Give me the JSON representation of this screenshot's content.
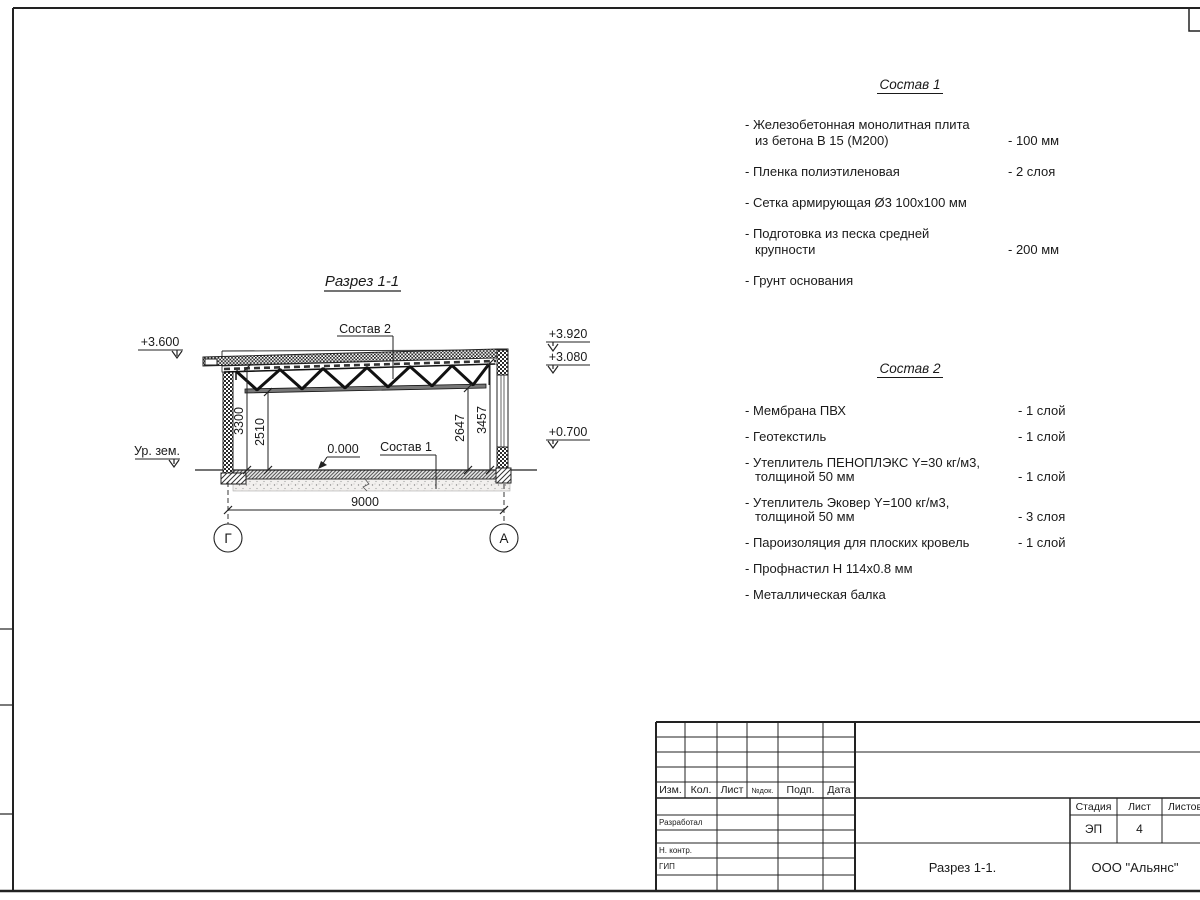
{
  "drawing": {
    "title": "Разрез 1-1",
    "labels": {
      "sostav2_ref": "Состав 2",
      "sostav1_ref": "Состав 1",
      "zero_level": "0.000",
      "ground_level": "Ур. зем."
    },
    "elevations": {
      "left_roof": "+3.600",
      "right_parapet": "+3.920",
      "right_window_top": "+3.080",
      "right_sill": "+0.700"
    },
    "dimensions": {
      "d3300": "3300",
      "d2510": "2510",
      "d2647": "2647",
      "d3457": "3457",
      "d9000": "9000"
    },
    "axes": {
      "left": "Г",
      "right": "А"
    }
  },
  "lists": [
    {
      "title": "Состав 1",
      "items": [
        {
          "lines": [
            "- Железобетонная  монолитная плита",
            "из бетона В 15 (М200)"
          ],
          "value": "- 100 мм"
        },
        {
          "lines": [
            "- Пленка полиэтиленовая"
          ],
          "value": "-  2 слоя"
        },
        {
          "lines": [
            "- Сетка армирующая Ø3 100х100 мм"
          ],
          "value": ""
        },
        {
          "lines": [
            "- Подготовка из песка средней",
            "крупности"
          ],
          "value": "- 200 мм"
        },
        {
          "lines": [
            "- Грунт основания"
          ],
          "value": ""
        }
      ]
    },
    {
      "title": "Состав 2",
      "items": [
        {
          "lines": [
            "- Мембрана ПВХ"
          ],
          "value": "- 1 слой"
        },
        {
          "lines": [
            "- Геотекстиль"
          ],
          "value": "- 1 слой"
        },
        {
          "lines": [
            "- Утеплитель ПЕНОПЛЭКС Y=30 кг/м3,",
            "толщиной 50 мм"
          ],
          "value": "- 1 слой"
        },
        {
          "lines": [
            "- Утеплитель Эковер Y=100 кг/м3,",
            "толщиной 50 мм"
          ],
          "value": "- 3 слоя"
        },
        {
          "lines": [
            "- Пароизоляция для плоских кровель"
          ],
          "value": "- 1 слой"
        },
        {
          "lines": [
            "- Профнастил Н 114х0.8 мм"
          ],
          "value": ""
        },
        {
          "lines": [
            "- Металлическая балка"
          ],
          "value": ""
        }
      ]
    }
  ],
  "title_block": {
    "rev_headers": [
      "Изм.",
      "Кол.",
      "Лист",
      "№док.",
      "Подп.",
      "Дата"
    ],
    "row_labels": [
      "Разработал",
      "Н. контр.",
      "ГИП"
    ],
    "stage_header": "Стадия",
    "sheet_header": "Лист",
    "sheets_header": "Листов",
    "stage_value": "ЭП",
    "sheet_value": "4",
    "doc_title": "Разрез 1-1.",
    "company": "ООО \"Альянс\""
  }
}
